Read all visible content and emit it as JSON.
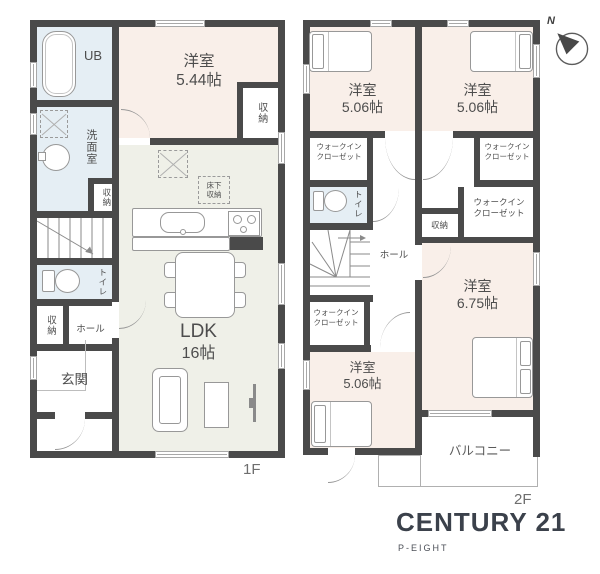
{
  "floor1": {
    "label": "1F",
    "ub": "UB",
    "washroom": "洗面室",
    "storage_mid": "収納",
    "toilet": "トイレ",
    "storage_hall": "収納",
    "hall": "ホール",
    "entrance": "玄関",
    "bedroom": {
      "name": "洋室",
      "size": "5.44帖"
    },
    "closet": "収納",
    "ldk": {
      "name": "LDK",
      "size": "16帖"
    },
    "underfloor": {
      "line1": "床下",
      "line2": "収納"
    }
  },
  "floor2": {
    "label": "2F",
    "bedroom_nw": {
      "name": "洋室",
      "size": "5.06帖"
    },
    "bedroom_ne": {
      "name": "洋室",
      "size": "5.06帖"
    },
    "bedroom_se": {
      "name": "洋室",
      "size": "6.75帖"
    },
    "bedroom_sw": {
      "name": "洋室",
      "size": "5.06帖"
    },
    "wic": {
      "line1": "ウォークイン",
      "line2": "クローゼット"
    },
    "toilet": "トイレ",
    "storage": "収納",
    "hall": "ホール",
    "balcony": "バルコニー"
  },
  "compass": {
    "north": "N"
  },
  "logo": {
    "brand": "CENTURY 21",
    "company": "P-EIGHT"
  },
  "colors": {
    "wall": "#4a4a4a",
    "bedroom_fill": "#f9efe9",
    "ldk_fill": "#eff0e8",
    "wet_area_fill": "#e5eef4",
    "outline": "#989898",
    "logo_text": "#3b414b",
    "floor_label": "#6e6e6e"
  }
}
